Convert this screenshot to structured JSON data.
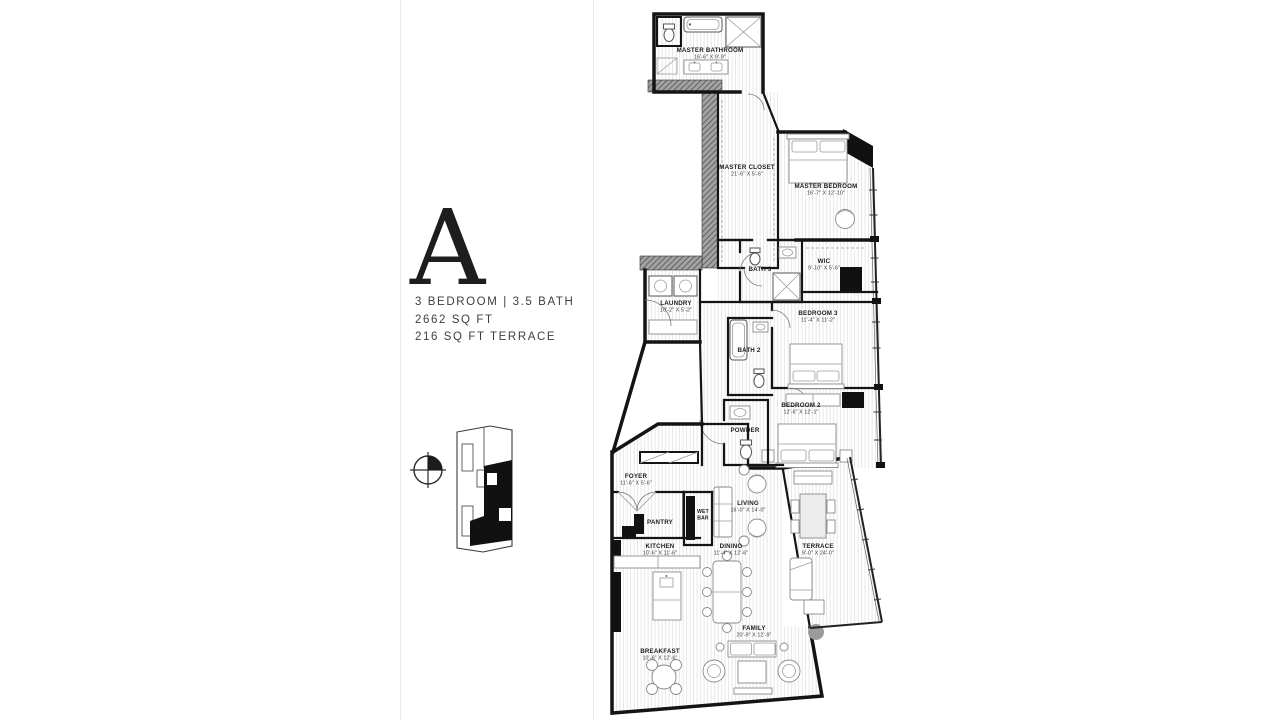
{
  "unit_info": {
    "letter": "A",
    "spec_line1": "3 BEDROOM | 3.5 BATH",
    "spec_line2": "2662 SQ FT",
    "spec_line3": "216 SQ FT TERRACE"
  },
  "colors": {
    "wall": "#141414",
    "hatch_wall": "#9a9a9a",
    "floor_stripe": "#e4e4e4",
    "column_marker": "#9b9b9b",
    "keyplan_highlight": "#111111"
  },
  "keyplan": {
    "compass": "compass-icon",
    "highlighted_unit": "A"
  },
  "rooms": {
    "master_bathroom": {
      "name": "MASTER BATHROOM",
      "dims": "16'-6\" X 9'-9\""
    },
    "master_closet": {
      "name": "MASTER CLOSET",
      "dims": "21'-6\" X 5'-6\""
    },
    "master_bedroom": {
      "name": "MASTER BEDROOM",
      "dims": "16'-7\" X 12'-10\""
    },
    "bath_3": {
      "name": "BATH 3",
      "dims": ""
    },
    "wic": {
      "name": "WIC",
      "dims": "9'-10\" X 5'-6\""
    },
    "laundry": {
      "name": "LAUNDRY",
      "dims": "10'-2\" X 5'-2\""
    },
    "bedroom_3": {
      "name": "BEDROOM 3",
      "dims": "11'-4\" X 11'-2\""
    },
    "bath_2": {
      "name": "BATH 2",
      "dims": ""
    },
    "bedroom_2": {
      "name": "BEDROOM 2",
      "dims": "12'-6\" X 12'-1\""
    },
    "powder": {
      "name": "POWDER",
      "dims": ""
    },
    "foyer": {
      "name": "FOYER",
      "dims": "11'-6\" X 5'-6\""
    },
    "wet_bar": {
      "name_line1": "WET",
      "name_line2": "BAR"
    },
    "pantry": {
      "name": "PANTRY",
      "dims": ""
    },
    "living": {
      "name": "LIVING",
      "dims": "16'-0\" X 14'-0\""
    },
    "kitchen": {
      "name": "KITCHEN",
      "dims": "10'-6\" X 11'-6\""
    },
    "dining": {
      "name": "DINING",
      "dims": "11'-4\" X 12'-6\""
    },
    "terrace": {
      "name": "TERRACE",
      "dims": "9'-0\" X 24'-0\""
    },
    "family": {
      "name": "FAMILY",
      "dims": "20'-9\" X 12'-9\""
    },
    "breakfast": {
      "name": "BREAKFAST",
      "dims": "10'-6\" X 12'-6\""
    }
  }
}
